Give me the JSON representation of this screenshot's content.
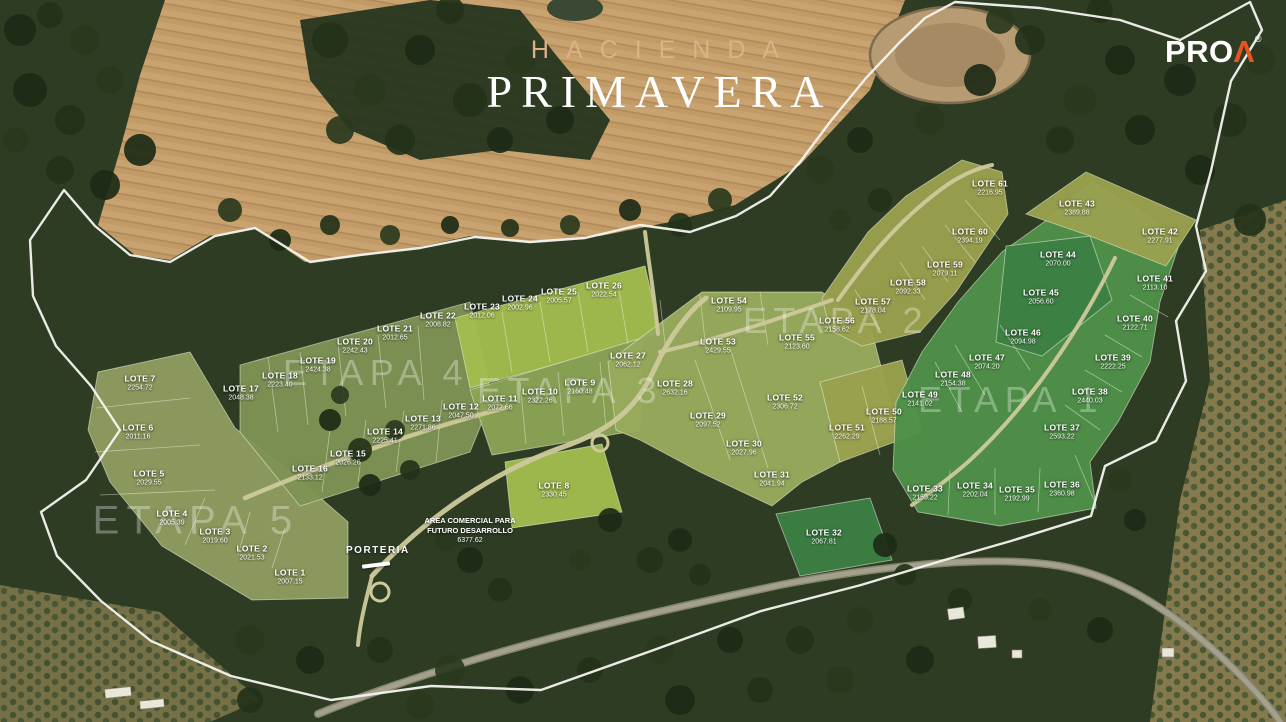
{
  "brand": {
    "line1": "HACIENDA",
    "line2": "PRIMAVERA"
  },
  "logo": {
    "text": "PRO",
    "mark": "Λ",
    "registered": "®"
  },
  "labels": {
    "porteria": "PORTERIA",
    "commercial_line1": "AREA COMERCIAL PARA",
    "commercial_line2": "FUTURO DESARROLLO",
    "commercial_area": "6377.62"
  },
  "etapas": [
    {
      "label": "ETAPA 1",
      "x": 1011,
      "y": 400,
      "size": 36
    },
    {
      "label": "ETAPA 2",
      "x": 836,
      "y": 321,
      "size": 36
    },
    {
      "label": "ETAPA 3",
      "x": 570,
      "y": 391,
      "size": 36
    },
    {
      "label": "ETAPA 4",
      "x": 376,
      "y": 373,
      "size": 36
    },
    {
      "label": "ETAPA 5",
      "x": 196,
      "y": 521,
      "size": 40
    }
  ],
  "lots": [
    {
      "name": "LOTE 1",
      "area": "2007.15",
      "x": 290,
      "y": 577
    },
    {
      "name": "LOTE 2",
      "area": "2021.53",
      "x": 252,
      "y": 553
    },
    {
      "name": "LOTE 3",
      "area": "2019.60",
      "x": 215,
      "y": 536
    },
    {
      "name": "LOTE 4",
      "area": "2005.39",
      "x": 172,
      "y": 518
    },
    {
      "name": "LOTE 5",
      "area": "2029.55",
      "x": 149,
      "y": 478
    },
    {
      "name": "LOTE 6",
      "area": "2011.16",
      "x": 138,
      "y": 432
    },
    {
      "name": "LOTE 7",
      "area": "2254.72",
      "x": 140,
      "y": 383
    },
    {
      "name": "LOTE 8",
      "area": "2330.45",
      "x": 554,
      "y": 490
    },
    {
      "name": "LOTE 9",
      "area": "2160.48",
      "x": 580,
      "y": 387
    },
    {
      "name": "LOTE 10",
      "area": "2322.26",
      "x": 540,
      "y": 396
    },
    {
      "name": "LOTE 11",
      "area": "2072.66",
      "x": 500,
      "y": 403
    },
    {
      "name": "LOTE 12",
      "area": "2047.50",
      "x": 461,
      "y": 411
    },
    {
      "name": "LOTE 13",
      "area": "2271.86",
      "x": 423,
      "y": 423
    },
    {
      "name": "LOTE 14",
      "area": "2225.41",
      "x": 385,
      "y": 436
    },
    {
      "name": "LOTE 15",
      "area": "2026.26",
      "x": 348,
      "y": 458
    },
    {
      "name": "LOTE 16",
      "area": "2133.12",
      "x": 310,
      "y": 473
    },
    {
      "name": "LOTE 17",
      "area": "2048.38",
      "x": 241,
      "y": 393
    },
    {
      "name": "LOTE 18",
      "area": "2223.40",
      "x": 280,
      "y": 380
    },
    {
      "name": "LOTE 19",
      "area": "2424.38",
      "x": 318,
      "y": 365
    },
    {
      "name": "LOTE 20",
      "area": "2242.43",
      "x": 355,
      "y": 346
    },
    {
      "name": "LOTE 21",
      "area": "2012.65",
      "x": 395,
      "y": 333
    },
    {
      "name": "LOTE 22",
      "area": "2008.82",
      "x": 438,
      "y": 320
    },
    {
      "name": "LOTE 23",
      "area": "2012.06",
      "x": 482,
      "y": 311
    },
    {
      "name": "LOTE 24",
      "area": "2002.96",
      "x": 520,
      "y": 303
    },
    {
      "name": "LOTE 25",
      "area": "2005.57",
      "x": 559,
      "y": 296
    },
    {
      "name": "LOTE 26",
      "area": "2022.54",
      "x": 604,
      "y": 290
    },
    {
      "name": "LOTE 27",
      "area": "2062.12",
      "x": 628,
      "y": 360
    },
    {
      "name": "LOTE 28",
      "area": "2632.16",
      "x": 675,
      "y": 388
    },
    {
      "name": "LOTE 29",
      "area": "2097.52",
      "x": 708,
      "y": 420
    },
    {
      "name": "LOTE 30",
      "area": "2027.96",
      "x": 744,
      "y": 448
    },
    {
      "name": "LOTE 31",
      "area": "2041.94",
      "x": 772,
      "y": 479
    },
    {
      "name": "LOTE 32",
      "area": "2067.81",
      "x": 824,
      "y": 537
    },
    {
      "name": "LOTE 33",
      "area": "2159.22",
      "x": 925,
      "y": 493
    },
    {
      "name": "LOTE 34",
      "area": "2202.04",
      "x": 975,
      "y": 490
    },
    {
      "name": "LOTE 35",
      "area": "2192.99",
      "x": 1017,
      "y": 494
    },
    {
      "name": "LOTE 36",
      "area": "2360.98",
      "x": 1062,
      "y": 489
    },
    {
      "name": "LOTE 37",
      "area": "2593.22",
      "x": 1062,
      "y": 432
    },
    {
      "name": "LOTE 38",
      "area": "2440.03",
      "x": 1090,
      "y": 396
    },
    {
      "name": "LOTE 39",
      "area": "2222.25",
      "x": 1113,
      "y": 362
    },
    {
      "name": "LOTE 40",
      "area": "2122.71",
      "x": 1135,
      "y": 323
    },
    {
      "name": "LOTE 41",
      "area": "2113.10",
      "x": 1155,
      "y": 283
    },
    {
      "name": "LOTE 42",
      "area": "2277.91",
      "x": 1160,
      "y": 236
    },
    {
      "name": "LOTE 43",
      "area": "2389.88",
      "x": 1077,
      "y": 208
    },
    {
      "name": "LOTE 44",
      "area": "2070.00",
      "x": 1058,
      "y": 259
    },
    {
      "name": "LOTE 45",
      "area": "2056.60",
      "x": 1041,
      "y": 297
    },
    {
      "name": "LOTE 46",
      "area": "2094.98",
      "x": 1023,
      "y": 337
    },
    {
      "name": "LOTE 47",
      "area": "2074.20",
      "x": 987,
      "y": 362
    },
    {
      "name": "LOTE 48",
      "area": "2154.38",
      "x": 953,
      "y": 379
    },
    {
      "name": "LOTE 49",
      "area": "2141.02",
      "x": 920,
      "y": 399
    },
    {
      "name": "LOTE 50",
      "area": "2188.57",
      "x": 884,
      "y": 416
    },
    {
      "name": "LOTE 51",
      "area": "2262.29",
      "x": 847,
      "y": 432
    },
    {
      "name": "LOTE 52",
      "area": "2306.72",
      "x": 785,
      "y": 402
    },
    {
      "name": "LOTE 53",
      "area": "2429.55",
      "x": 718,
      "y": 346
    },
    {
      "name": "LOTE 54",
      "area": "2109.95",
      "x": 729,
      "y": 305
    },
    {
      "name": "LOTE 55",
      "area": "2123.60",
      "x": 797,
      "y": 342
    },
    {
      "name": "LOTE 56",
      "area": "2158.62",
      "x": 837,
      "y": 325
    },
    {
      "name": "LOTE 57",
      "area": "2178.04",
      "x": 873,
      "y": 306
    },
    {
      "name": "LOTE 58",
      "area": "2092.33",
      "x": 908,
      "y": 287
    },
    {
      "name": "LOTE 59",
      "area": "2079.11",
      "x": 945,
      "y": 269
    },
    {
      "name": "LOTE 60",
      "area": "2394.19",
      "x": 970,
      "y": 236
    },
    {
      "name": "LOTE 61",
      "area": "2216.95",
      "x": 990,
      "y": 188
    }
  ],
  "colors": {
    "accent_orange": "#E8541D",
    "title_tan": "#DEB088",
    "etapa1_green": "#4F9149",
    "etapa2_olive": "#9AA04E",
    "etapa3_green": "#98AB5D",
    "etapa4_green": "#7F9355",
    "etapa4b_green": "#8AA355",
    "etapa5_olive": "#8F9C60",
    "bright_green": "#A3BC4F",
    "dark_lot_green": "#3C7F44",
    "boundary_white": "#F4F4EF",
    "road_tan": "#CDC99B",
    "field_tan": "#C9A36F",
    "forest_green": "#2E3C24"
  }
}
